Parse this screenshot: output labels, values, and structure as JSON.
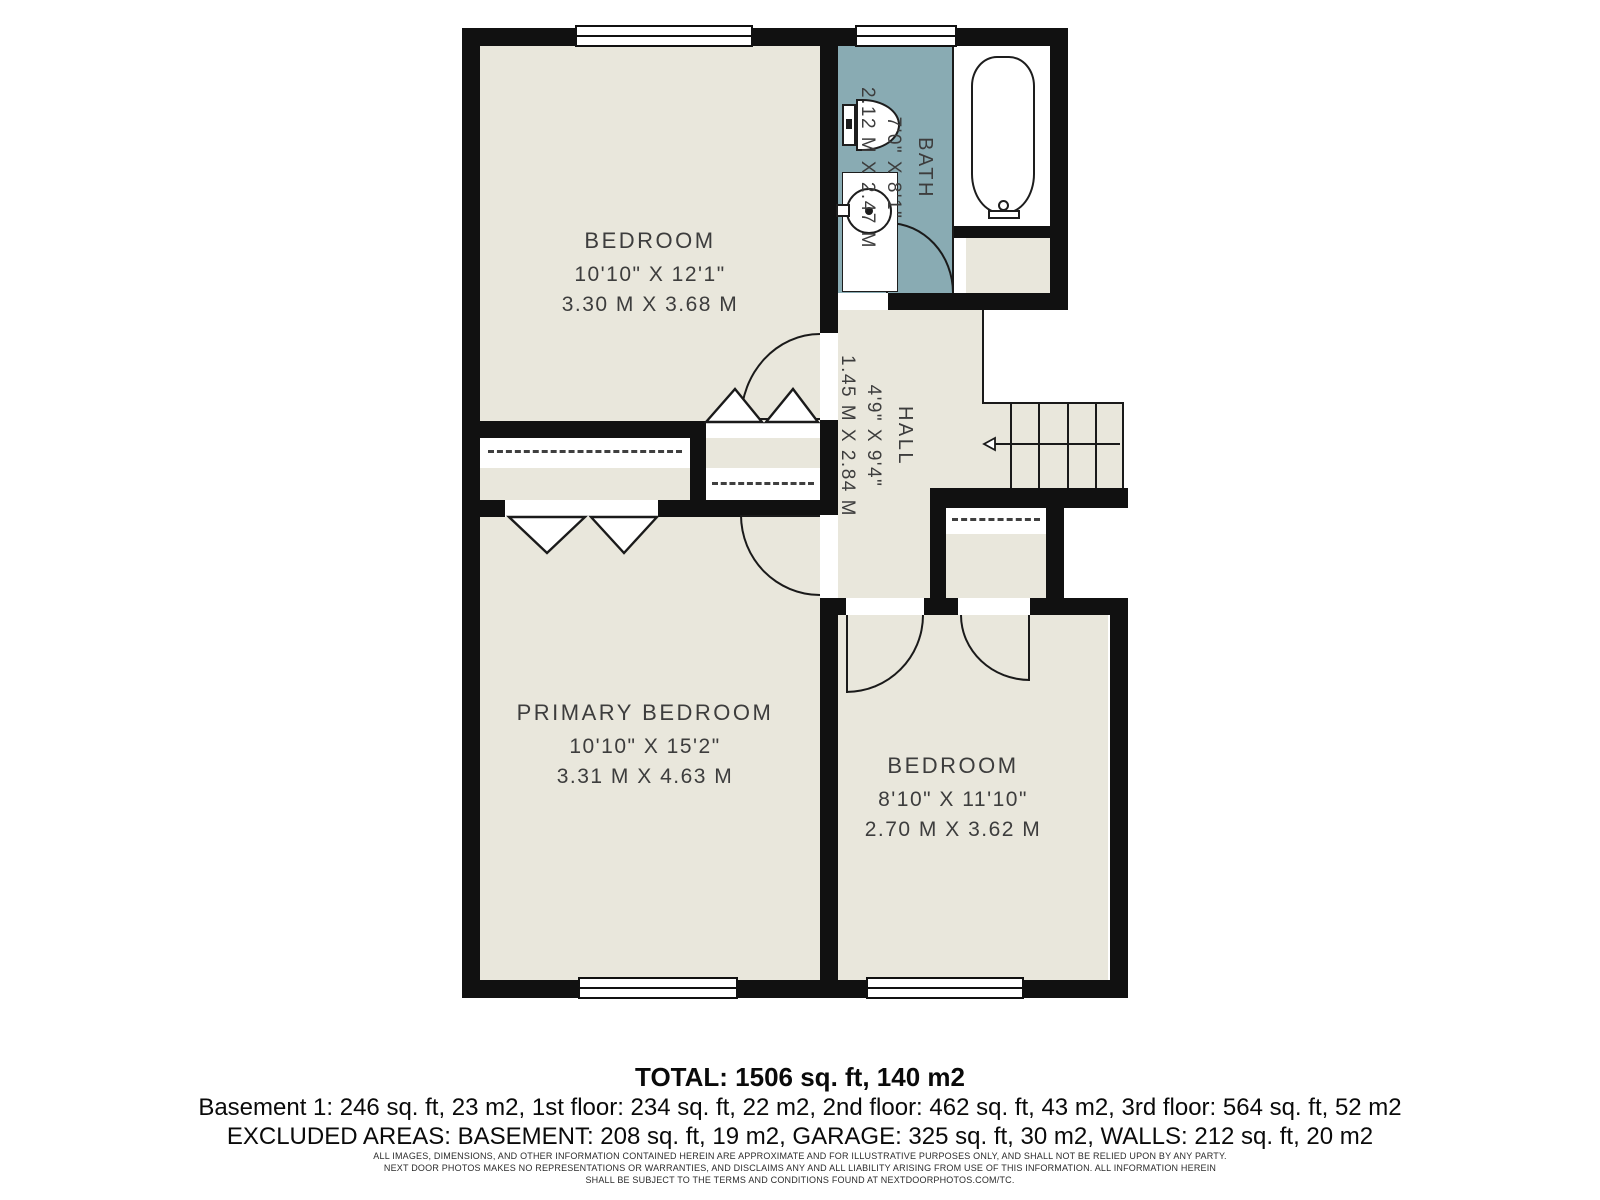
{
  "rooms": [
    {
      "id": "bedroom-top",
      "name": "BEDROOM",
      "imperial": "10'10\" X 12'1\"",
      "metric": "3.30 M X 3.68 M"
    },
    {
      "id": "bath",
      "name": "BATH",
      "imperial": "7'0\" X 8'1\"",
      "metric": "2.12 M X 2.47 M"
    },
    {
      "id": "hall",
      "name": "HALL",
      "imperial": "4'9\" X 9'4\"",
      "metric": "1.45 M X 2.84 M"
    },
    {
      "id": "primary-bedroom",
      "name": "PRIMARY BEDROOM",
      "imperial": "10'10\" X 15'2\"",
      "metric": "3.31 M X 4.63 M"
    },
    {
      "id": "bedroom-right",
      "name": "BEDROOM",
      "imperial": "8'10\" X 11'10\"",
      "metric": "2.70 M X 3.62 M"
    }
  ],
  "stairs": {
    "treads": 5,
    "arrow_direction": "left"
  },
  "summary": {
    "total": "TOTAL: 1506 sq. ft, 140 m2",
    "floors": "Basement 1: 246 sq. ft, 23 m2, 1st floor: 234 sq. ft, 22 m2, 2nd floor: 462 sq. ft, 43 m2, 3rd floor: 564 sq. ft, 52 m2",
    "excluded": "EXCLUDED AREAS: BASEMENT: 208 sq. ft, 19 m2, GARAGE: 325 sq. ft, 30 m2, WALLS: 212 sq. ft, 20 m2"
  },
  "disclaimer": {
    "line1": "ALL IMAGES, DIMENSIONS, AND OTHER INFORMATION CONTAINED HEREIN ARE APPROXIMATE AND FOR ILLUSTRATIVE PURPOSES ONLY, AND SHALL NOT BE RELIED UPON BY ANY PARTY.",
    "line2": "NEXT DOOR PHOTOS MAKES NO REPRESENTATIONS OR WARRANTIES, AND DISCLAIMS ANY AND ALL LIABILITY ARISING FROM USE OF THIS INFORMATION. ALL INFORMATION HEREIN",
    "line3": "SHALL BE SUBJECT TO THE TERMS AND CONDITIONS FOUND AT NEXTDOORPHOTOS.COM/TC."
  },
  "colors": {
    "wall": "#111111",
    "floor": "#e9e7dc",
    "bath": "#89abb3",
    "line": "#1a1a1a",
    "text": "#3d3d3d"
  }
}
